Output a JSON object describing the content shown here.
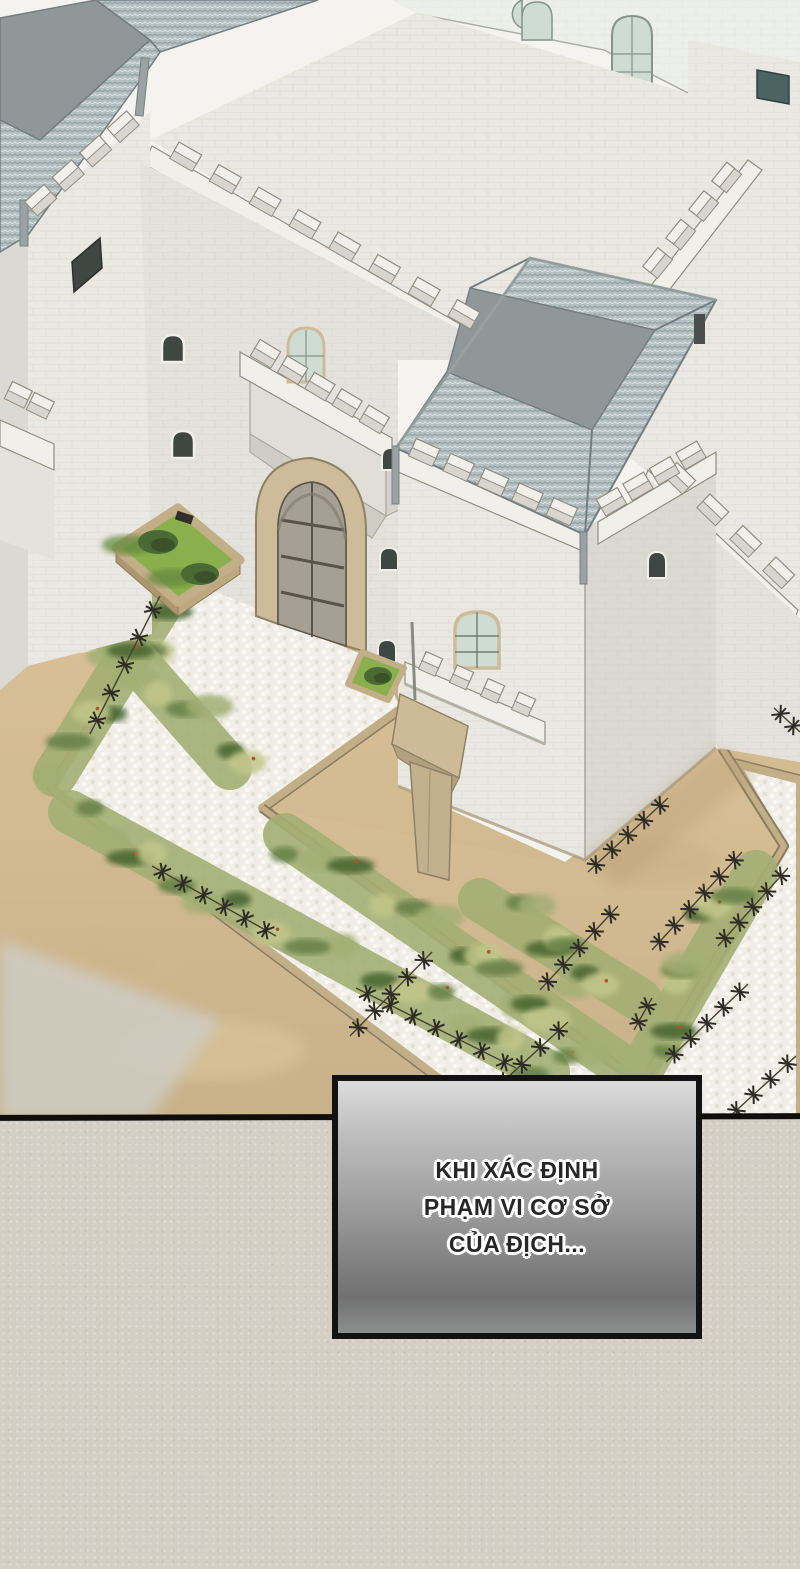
{
  "caption_box": {
    "lines": [
      "KHI XÁC ĐỊNH",
      "PHẠM VI CƠ SỞ",
      "CỦA ĐỊCH..."
    ]
  },
  "colors": {
    "paper": "#f4f3ef",
    "panel2_bg": "#d4cec5",
    "divider": "#0f0e0c",
    "box_border": "#121212",
    "box_text": "#262626",
    "facade": "#edefeb",
    "facade_line": "#b8bdb5",
    "wall_light": "#eae8e2",
    "wall_mid": "#e4e2dc",
    "wall_shadow": "#dbd9d3",
    "wall_deep": "#d0cec8",
    "parapet_white": "#f1efe9",
    "parapet_shadow": "#d8d5ce",
    "outline": "#918d82",
    "roof_flat": "#8f9798",
    "roof_edge": "#747e80",
    "glass": "#cfdcd4",
    "glass_line": "#84948a",
    "window_dark": "#3f4743",
    "teal_window": "#4b6361",
    "gate_frame": "#cdbb9a",
    "frame_line": "#8d8166",
    "door": "#a6a094",
    "door_line": "#59544b",
    "sand": "#d8bf94",
    "sand_dark": "#c9af83",
    "cobble": "#efede6",
    "curb": "#c2ae87",
    "curb_line": "#8a7c60",
    "grass_base": "#a3af74",
    "grass_dark": "#657f44",
    "grass_deep": "#46632f",
    "grass_light": "#c2c78b",
    "flower": "#b0512f",
    "planter_green": "#8ab04e",
    "tree": "#4a6a33",
    "tree_dark": "#39522a",
    "tree_shadow": "#64883c",
    "banner": "#cdbb98",
    "banner_dark": "#b3a07c",
    "wire": "#2e2c26"
  }
}
